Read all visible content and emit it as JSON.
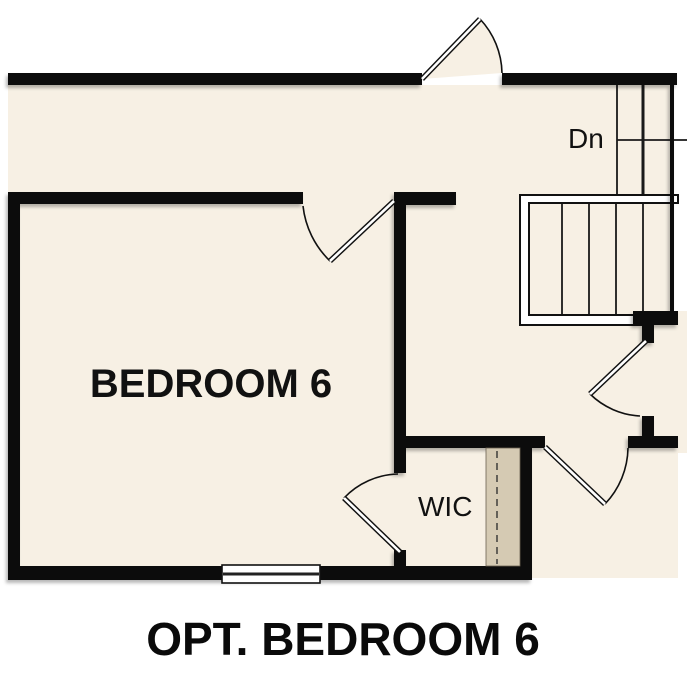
{
  "floor_plan": {
    "caption": "OPT. BEDROOM 6",
    "rooms": [
      {
        "name": "bedroom-6",
        "label": "BEDROOM 6"
      },
      {
        "name": "walk-in-closet",
        "label": "WIC"
      }
    ],
    "stairs": {
      "direction_label": "Dn",
      "lower_flight_treads": 5
    },
    "features": {
      "doors": [
        "top-exterior-door",
        "bedroom-door",
        "wic-door",
        "hall-door-upper",
        "hall-door-lower"
      ],
      "windows": [
        "bedroom-bottom-window"
      ],
      "closet_shelf_with_rod": true
    },
    "colors": {
      "floor": "#f7f0e4",
      "wall": "#0c0c0c",
      "closet_shelf": "#d5cab3",
      "exterior": "#ffffff",
      "text": "#111111"
    }
  }
}
